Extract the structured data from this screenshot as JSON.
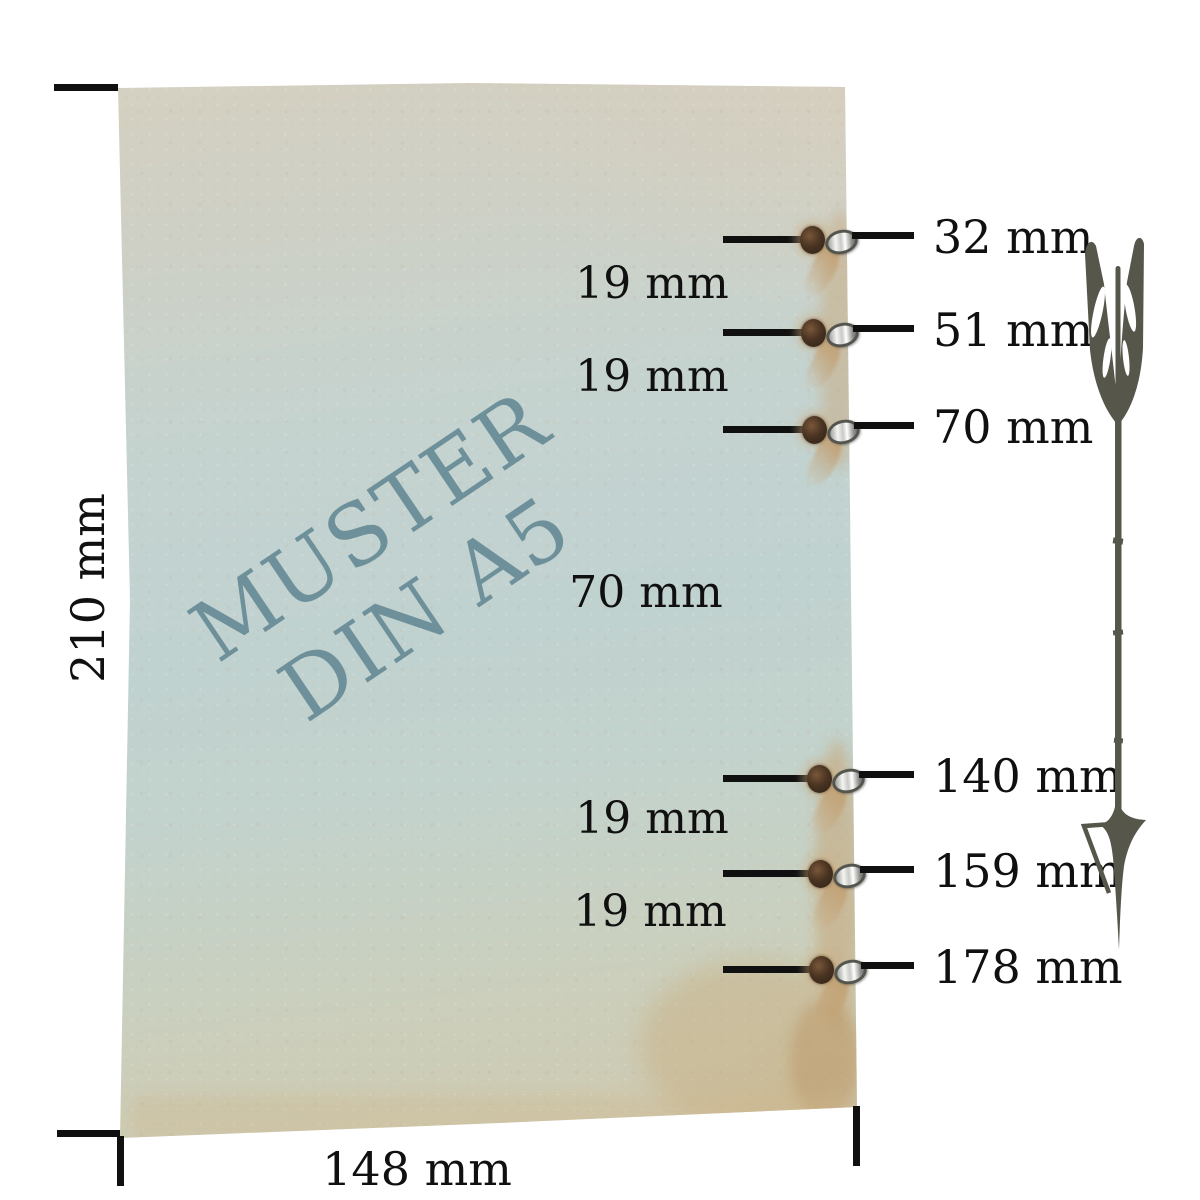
{
  "diagram": {
    "type": "hole-position-measurement-diagram",
    "watermark": {
      "line1": "MUSTER",
      "line2": "DIN A5"
    },
    "height_label": "210 mm",
    "width_label": "148 mm",
    "holes": [
      {
        "label": "32 mm",
        "y": 240
      },
      {
        "label": "51 mm",
        "y": 333
      },
      {
        "label": "70 mm",
        "y": 430
      },
      {
        "label": "140 mm",
        "y": 779
      },
      {
        "label": "159 mm",
        "y": 874
      },
      {
        "label": "178 mm",
        "y": 970
      }
    ],
    "gaps": [
      {
        "label": "19 mm",
        "x": 652,
        "y": 284
      },
      {
        "label": "19 mm",
        "x": 652,
        "y": 377
      },
      {
        "label": "70 mm",
        "x": 646,
        "y": 593
      },
      {
        "label": "19 mm",
        "x": 652,
        "y": 819
      },
      {
        "label": "19 mm",
        "x": 650,
        "y": 912
      }
    ],
    "colors": {
      "ink": "#101010",
      "watermark_teal": "#6d909a",
      "arrow_olive": "#57564a",
      "paper_beige": "#d6d0c0",
      "paper_blue": "#c0d2d0",
      "stain_tan": "#c8a87e",
      "eyelet_silver": "#e8e8e6",
      "hole_brown": "#4a3422"
    }
  }
}
